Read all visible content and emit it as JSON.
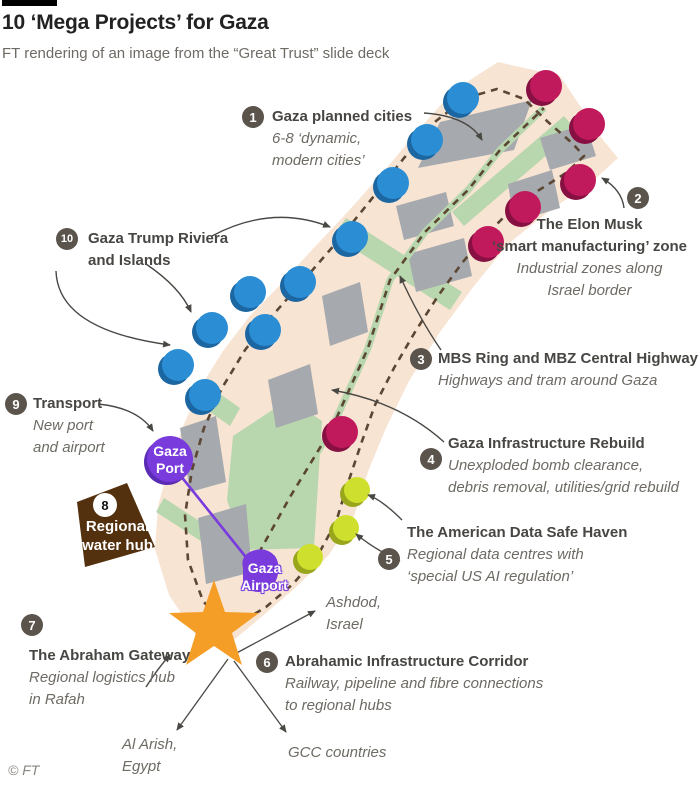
{
  "header": {
    "title": "10 ‘Mega Projects’ for Gaza",
    "subtitle": "FT rendering of an image from the “Great Trust” slide deck"
  },
  "a1": {
    "num": "1",
    "t1": "Gaza planned cities",
    "s1": "6-8 ‘dynamic,",
    "s2": "modern cities’"
  },
  "a2": {
    "num": "2",
    "t1": "The Elon Musk",
    "t2": "‘smart manufacturing’ zone",
    "s1": "Industrial zones along",
    "s2": "Israel border"
  },
  "a3": {
    "num": "3",
    "t1": "MBS Ring and MBZ Central Highway",
    "s1": "Highways and tram around Gaza"
  },
  "a4": {
    "num": "4",
    "t1": "Gaza Infrastructure Rebuild",
    "s1": "Unexploded bomb clearance,",
    "s2": "debris removal, utilities/grid rebuild"
  },
  "a5": {
    "num": "5",
    "t1": "The American Data Safe Haven",
    "s1": "Regional data centres with",
    "s2": "‘special US AI regulation’"
  },
  "a6": {
    "num": "6",
    "t1": "Abrahamic Infrastructure Corridor",
    "s1": "Railway, pipeline and fibre connections",
    "s2": "to regional hubs"
  },
  "a7": {
    "num": "7",
    "t1": "The Abraham Gateway",
    "s1": "Regional logistics hub",
    "s2": "in Rafah"
  },
  "a8": {
    "num": "8",
    "t1": "Regional",
    "t2": "water hub"
  },
  "a9": {
    "num": "9",
    "t1": "Transport",
    "s1": "New port",
    "s2": "and airport"
  },
  "a10": {
    "num": "10",
    "t1": "Gaza Trump Riviera",
    "t2": "and Islands"
  },
  "port": {
    "l1": "Gaza",
    "l2": "Port"
  },
  "airport": {
    "l1": "Gaza",
    "l2": "Airport"
  },
  "dest": {
    "ashdod1": "Ashdod,",
    "ashdod2": "Israel",
    "alarish1": "Al Arish,",
    "alarish2": "Egypt",
    "gcc": "GCC countries"
  },
  "footer": {
    "credit": "© FT"
  },
  "colors": {
    "band": "#f7e4d3",
    "city": "#a6a9ad",
    "green": "#b9d7ae",
    "road": "#5c4734",
    "blue": "#2b8ed4",
    "blue_sh": "#1c66a2",
    "magenta": "#c01a5c",
    "magenta_sh": "#871043",
    "lime": "#cfdf2e",
    "lime_sh": "#99a61c",
    "purple": "#7a3bdc",
    "purple_sh": "#5a2bb5",
    "orange": "#f59e27",
    "brown": "#53300e",
    "numc": "#5b544d",
    "text_dark": "#484643",
    "text_it": "#6e6a64",
    "arrow": "#4a4844"
  }
}
